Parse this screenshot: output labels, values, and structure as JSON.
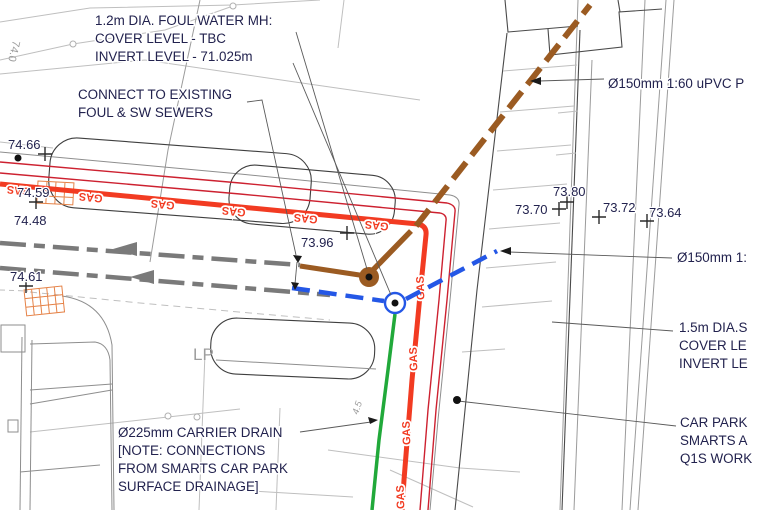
{
  "annotations": [
    {
      "id": "foul-water-mh",
      "lines": [
        "1.2m DIA. FOUL WATER MH:",
        "COVER LEVEL - TBC",
        "INVERT LEVEL - 71.025m"
      ]
    },
    {
      "id": "connect-existing",
      "lines": [
        "CONNECT TO EXISTING",
        "FOUL & SW SEWERS"
      ]
    },
    {
      "id": "upvc-pipe",
      "lines": [
        "Ø150mm 1:60 uPVC P"
      ]
    },
    {
      "id": "pipe-150",
      "lines": [
        "Ø150mm 1:"
      ]
    },
    {
      "id": "mh-1-5",
      "lines": [
        "1.5m DIA.S",
        "COVER LE",
        "INVERT LE"
      ]
    },
    {
      "id": "car-park",
      "lines": [
        "CAR PARK",
        "SMARTS A",
        "Q1S WORK"
      ]
    },
    {
      "id": "carrier-drain",
      "lines": [
        "Ø225mm CARRIER DRAIN",
        "[NOTE: CONNECTIONS",
        "FROM SMARTS CAR PARK",
        "SURFACE DRAINAGE]"
      ]
    }
  ],
  "spot_levels": [
    "74.66",
    "74.59",
    "74.48",
    "74.61",
    "73.96",
    "73.80",
    "73.70",
    "73.72",
    "73.64"
  ],
  "utility_labels": {
    "gas": "GAS"
  },
  "misc_labels": {
    "lamp_post": "LP",
    "contour_level": "74.0",
    "dimension": "4.5"
  },
  "legend_colors": {
    "gas_main": "#f23b22",
    "boundary_line": "#cd2130",
    "foul_sewer": "#9b5b22",
    "surface_water_sewer": "#2457e6",
    "carrier_drain": "#21a93a",
    "hatch": "#e58247",
    "annotation_text": "#22224e"
  }
}
